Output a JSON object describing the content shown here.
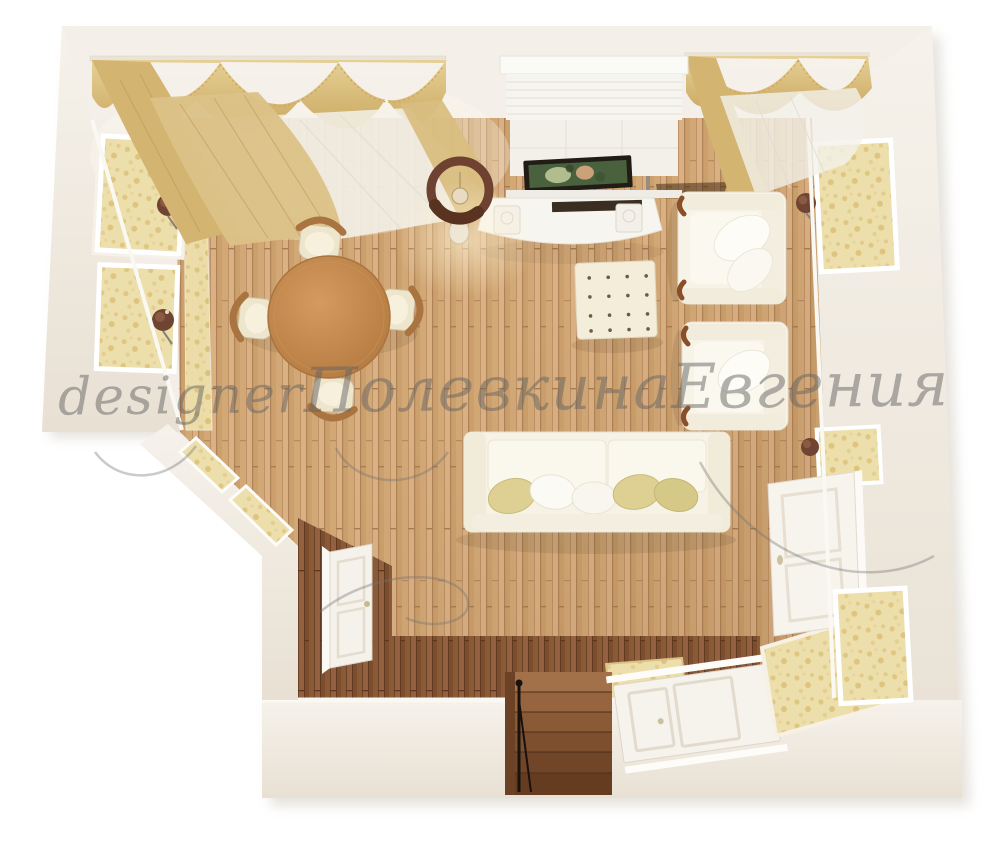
{
  "watermark": {
    "word1": "designer",
    "word2": "Полевкина",
    "word3": "Евгения"
  },
  "palette": {
    "wall_cream": "#f3efe8",
    "floor_light": "#d2a877",
    "floor_dark": "#8a5a38",
    "wallpaper_gold": "#eddfab",
    "curtain_gold": "#d9bd7f",
    "upholstery_cream": "#f6f2e5",
    "pillow_gold": "#ddd092",
    "table_wood": "#c08a52",
    "sconce_brown": "#6f4433",
    "tv_frame": "#221c17",
    "tv_screen": "#4a613d",
    "railing_black": "#17120e"
  }
}
